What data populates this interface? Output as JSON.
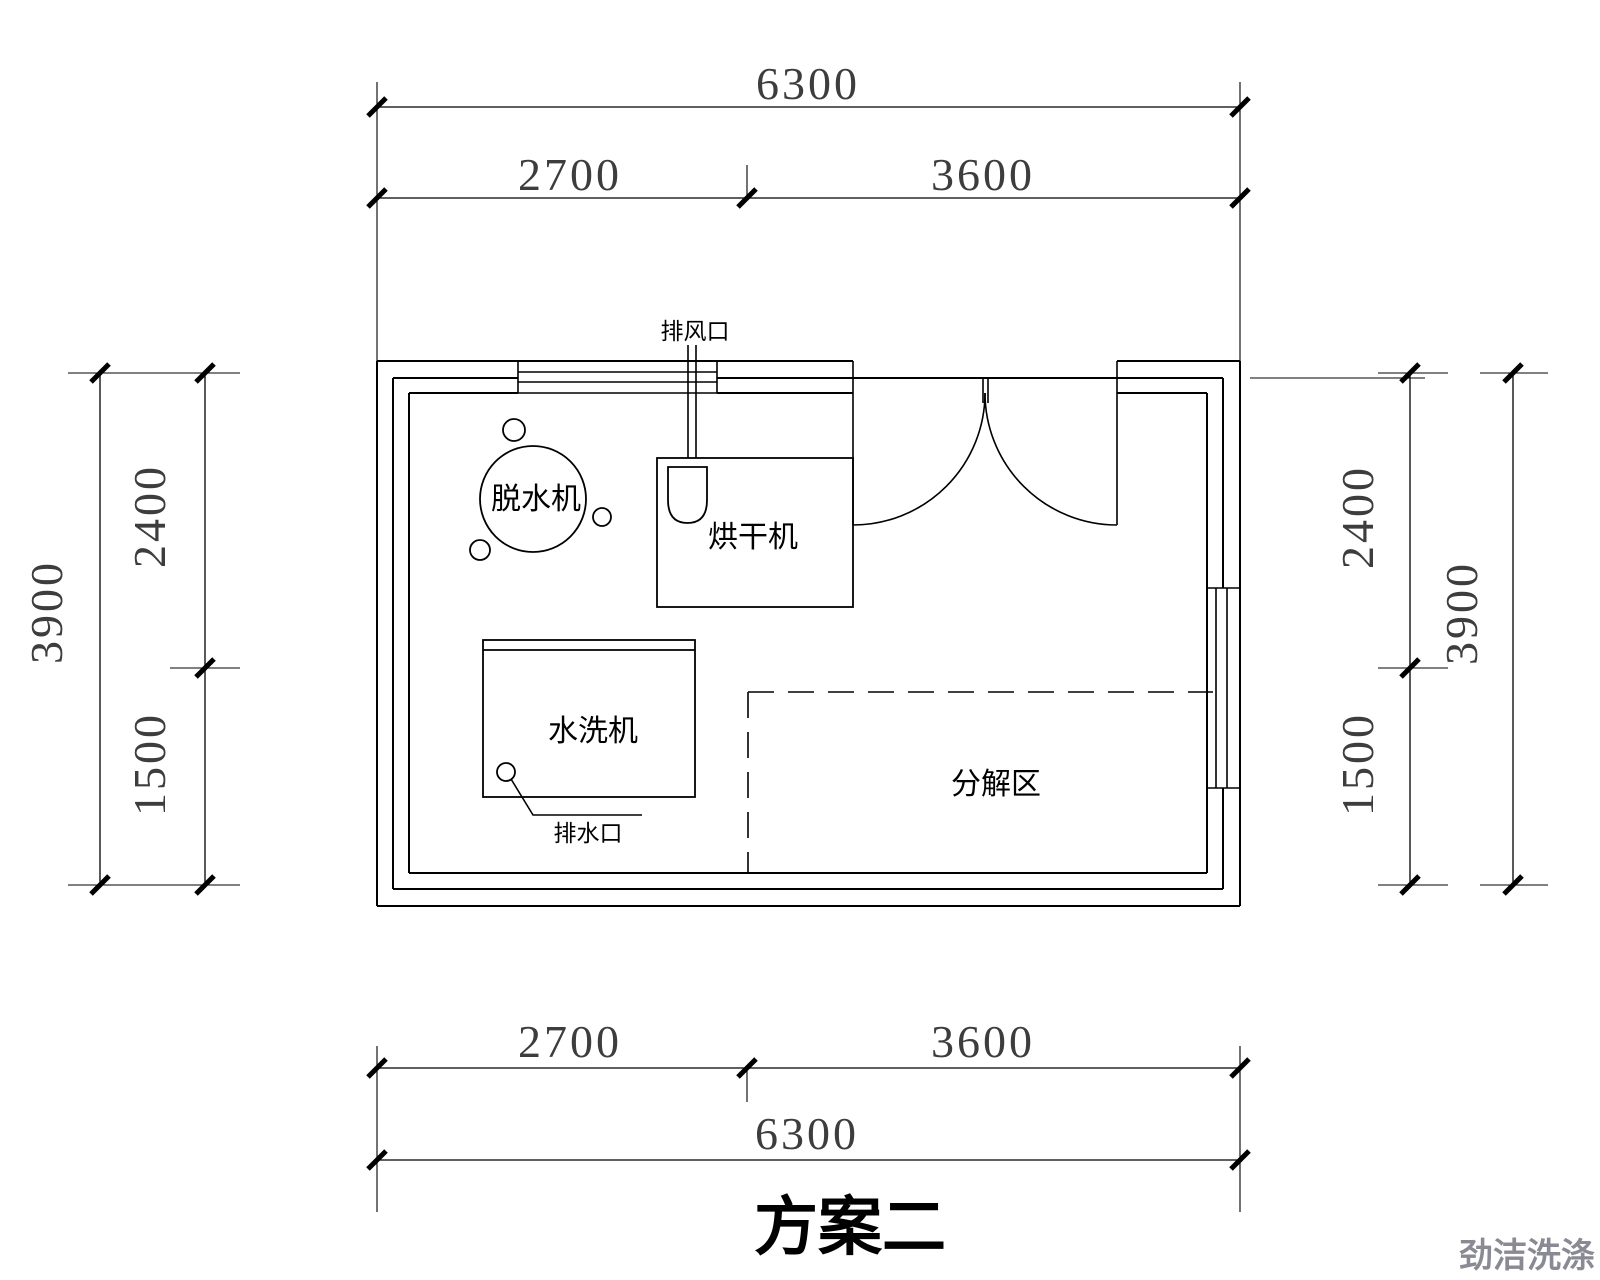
{
  "drawing": {
    "title": "方案二",
    "watermark": "劲洁洗涤",
    "room": {
      "equipment": {
        "dehydrator": "脱水机",
        "dryer": "烘干机",
        "washer": "水洗机",
        "decompose_area": "分解区"
      },
      "annotations": {
        "exhaust_vent": "排风口",
        "drain_outlet": "排水口"
      }
    },
    "dimensions": {
      "top": {
        "total": "6300",
        "segments": [
          "2700",
          "3600"
        ]
      },
      "bottom": {
        "total": "6300",
        "segments": [
          "2700",
          "3600"
        ]
      },
      "left": {
        "total": "3900",
        "segments": [
          "2400",
          "1500"
        ]
      },
      "right": {
        "total": "3900",
        "segments": [
          "2400",
          "1500"
        ]
      }
    }
  },
  "colors": {
    "line": "#000000",
    "dimension_text": "#3d3d3d",
    "watermark": "#8a8a94",
    "background": "#ffffff"
  }
}
